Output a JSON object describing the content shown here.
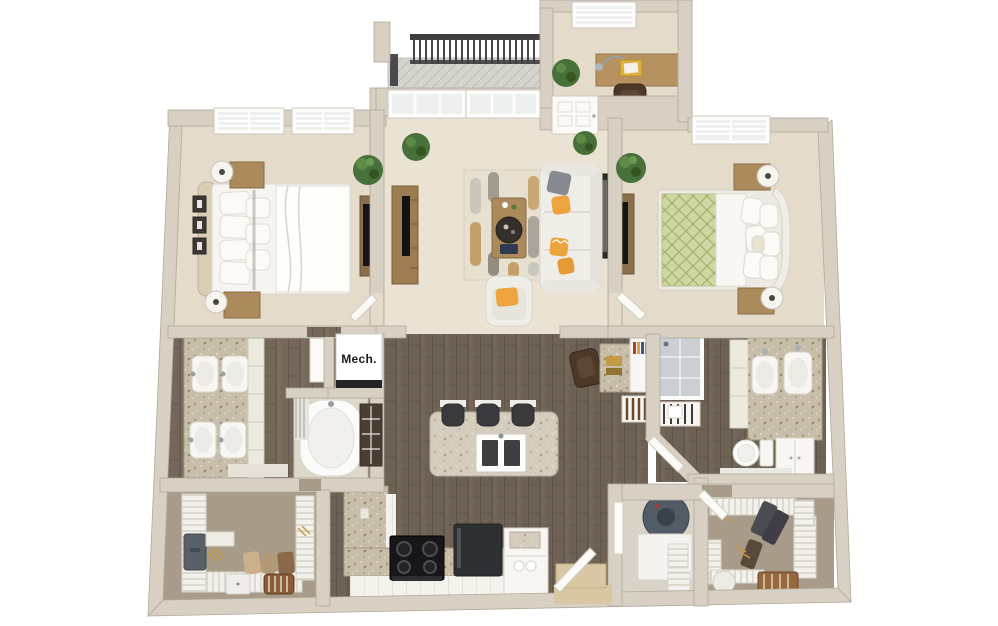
{
  "labels": {
    "mech_closet": "Mech."
  },
  "colors": {
    "background": "#ffffff",
    "wall": "#d7d0c3",
    "wall_edge": "#b2a998",
    "carpet": "#e4dbcb",
    "carpet_living": "#eae2d3",
    "closet_floor": "#a89b8a",
    "laundry_floor": "#d8d2c7",
    "wood": "#6e6255",
    "wood_bath": "#75675a",
    "granite": "#c7bda9",
    "granite_light": "#d4ccbd",
    "glass": "#eef0ef",
    "white_fixture": "#f7f6f2",
    "railing": "#3f3f42",
    "plant": "#4c773a",
    "accent_orange": "#eda43e",
    "bed_green": "#cdd7a0",
    "wood_furniture": "#ab8a5c",
    "dark_furniture": "#4c392a",
    "appliance_black": "#17171a",
    "water_heater": "#525c66",
    "threshold": "#d9c7a4"
  },
  "rooms": [
    {
      "id": "bedroom-1",
      "features": [
        "two-windows",
        "bed",
        "upholstered-headboard",
        "pillows",
        "nightstand",
        "nightstand",
        "table-lamp",
        "table-lamp",
        "wall-art-frames-3",
        "dresser-with-tv",
        "plant",
        "door"
      ]
    },
    {
      "id": "living-room",
      "features": [
        "balcony-windows",
        "balcony-door",
        "tv-console",
        "tv",
        "area-rug",
        "sectional-sofa",
        "gray-pillow",
        "orange-pillows",
        "coffee-table",
        "round-tray",
        "armchair",
        "wall-art",
        "plants"
      ]
    },
    {
      "id": "den",
      "features": [
        "window",
        "desk",
        "desk-lamp",
        "notebooks",
        "office-chair",
        "credenza",
        "plant"
      ]
    },
    {
      "id": "balcony",
      "features": [
        "metal-railing",
        "plank-floor"
      ]
    },
    {
      "id": "bedroom-2",
      "features": [
        "window",
        "bed",
        "green-patterned-duvet",
        "curved-headboard",
        "pillows",
        "nightstand",
        "nightstand",
        "table-lamp",
        "table-lamp",
        "dresser-with-tv",
        "plant",
        "door"
      ]
    },
    {
      "id": "bathroom-1",
      "features": [
        "granite-double-vanity",
        "four-sinks",
        "vanity-cabinets",
        "bathtub",
        "shower-curtain",
        "dark-tile-panel",
        "bath-mat",
        "door"
      ]
    },
    {
      "id": "mechanical-closet",
      "features": [
        "mech-unit"
      ]
    },
    {
      "id": "kitchen",
      "features": [
        "island-with-double-sink",
        "bar-stools-3",
        "granite-l-counter",
        "range-cooktop",
        "refrigerator",
        "cabinet-hutch",
        "outlet"
      ]
    },
    {
      "id": "hallway-nook",
      "features": [
        "built-in-desk",
        "desk-chair",
        "bookshelf",
        "wine-rack"
      ]
    },
    {
      "id": "bathroom-2",
      "features": [
        "glass-shower",
        "granite-vanity",
        "two-sinks",
        "toilet",
        "storage-cabinet",
        "slatted-bench",
        "bath-mat",
        "angled-door"
      ]
    },
    {
      "id": "laundry-closet",
      "features": [
        "water-heater",
        "washer",
        "wire-basket",
        "wire-shelf",
        "door"
      ]
    },
    {
      "id": "walk-in-closet-1",
      "features": [
        "wire-shelving",
        "suitcase",
        "shelf",
        "gold-hangers",
        "folded-clothes",
        "storage-box",
        "striped-ottoman"
      ]
    },
    {
      "id": "walk-in-closet-2",
      "features": [
        "wire-shelving",
        "hanging-clothes",
        "gold-hangers",
        "laundry-basket",
        "hamper",
        "striped-rug",
        "door"
      ]
    },
    {
      "id": "entry",
      "features": [
        "door-ajar",
        "threshold"
      ]
    }
  ]
}
